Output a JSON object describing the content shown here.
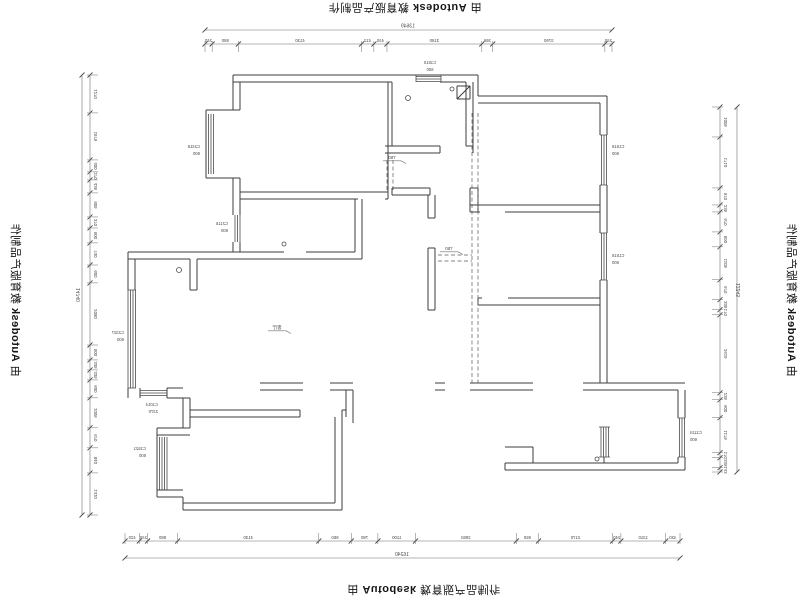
{
  "watermark": {
    "prefix": "由 ",
    "brand": "Autodesk",
    "suffix": " 教育版产品制作"
  },
  "colors": {
    "paper": "#ffffff",
    "wall": "#3d3d3d",
    "window": "#4a4a4a",
    "dim_line": "#6f6f6f",
    "dim_text": "#4a4a4a",
    "dashed": "#5a5a5a",
    "watermark": "#161616"
  },
  "dimensions": {
    "top": {
      "overall": "13649",
      "segments": [
        240,
        880,
        4130,
        413,
        440,
        3180,
        366,
        3760,
        240
      ]
    },
    "bottom": {
      "overall": "16240",
      "segments": [
        420,
        240,
        880,
        4130,
        950,
        780,
        1100,
        2950,
        650,
        2170,
        240,
        1310,
        420
      ]
    },
    "left": {
      "overall": "14740",
      "segments": [
        1270,
        1575,
        400,
        270,
        435,
        805,
        370,
        500,
        740,
        600,
        2080,
        500,
        335,
        335,
        600,
        1005,
        670,
        840,
        1410
      ]
    },
    "right": {
      "overall": "12243",
      "segments": [
        1005,
        1710,
        570,
        235,
        670,
        500,
        1105,
        670,
        335,
        170,
        2615,
        235,
        600,
        1175,
        170,
        335,
        143
      ]
    }
  },
  "window_tags": [
    {
      "id": "tag-bay-upper-left",
      "line1": "C2418",
      "line2": "600",
      "x": 200,
      "y": 148,
      "align": "right"
    },
    {
      "id": "tag-study-window",
      "line1": "C2115",
      "line2": "600",
      "x": 228,
      "y": 225,
      "align": "right"
    },
    {
      "id": "tag-west-wing-window",
      "line1": "C2327",
      "line2": "600",
      "x": 124,
      "y": 334,
      "align": "right"
    },
    {
      "id": "tag-small-window",
      "line1": "C1014",
      "line2": "2370",
      "x": 158,
      "y": 406,
      "align": "right"
    },
    {
      "id": "tag-bedroom-bay",
      "line1": "C1521",
      "line2": "600",
      "x": 146,
      "y": 450,
      "align": "right"
    },
    {
      "id": "tag-kitchen-window",
      "line1": "C1510",
      "line2": "600",
      "x": 430,
      "y": 64,
      "align": "center"
    },
    {
      "id": "tag-bedroom-a-window",
      "line1": "C1518",
      "line2": "600",
      "x": 612,
      "y": 148,
      "align": "left"
    },
    {
      "id": "tag-bedroom-b-window",
      "line1": "C1518",
      "line2": "600",
      "x": 612,
      "y": 257,
      "align": "left"
    },
    {
      "id": "tag-bath-window",
      "line1": "C1124",
      "line2": "600",
      "x": 690,
      "y": 434,
      "align": "left"
    }
  ],
  "notes": [
    {
      "id": "note-kitchen-demo",
      "text": "750",
      "x": 392,
      "y": 159
    },
    {
      "id": "note-hall-demo",
      "text": "750",
      "x": 449,
      "y": 250
    },
    {
      "id": "note-living-room",
      "text": "客厅",
      "x": 277,
      "y": 329
    }
  ]
}
